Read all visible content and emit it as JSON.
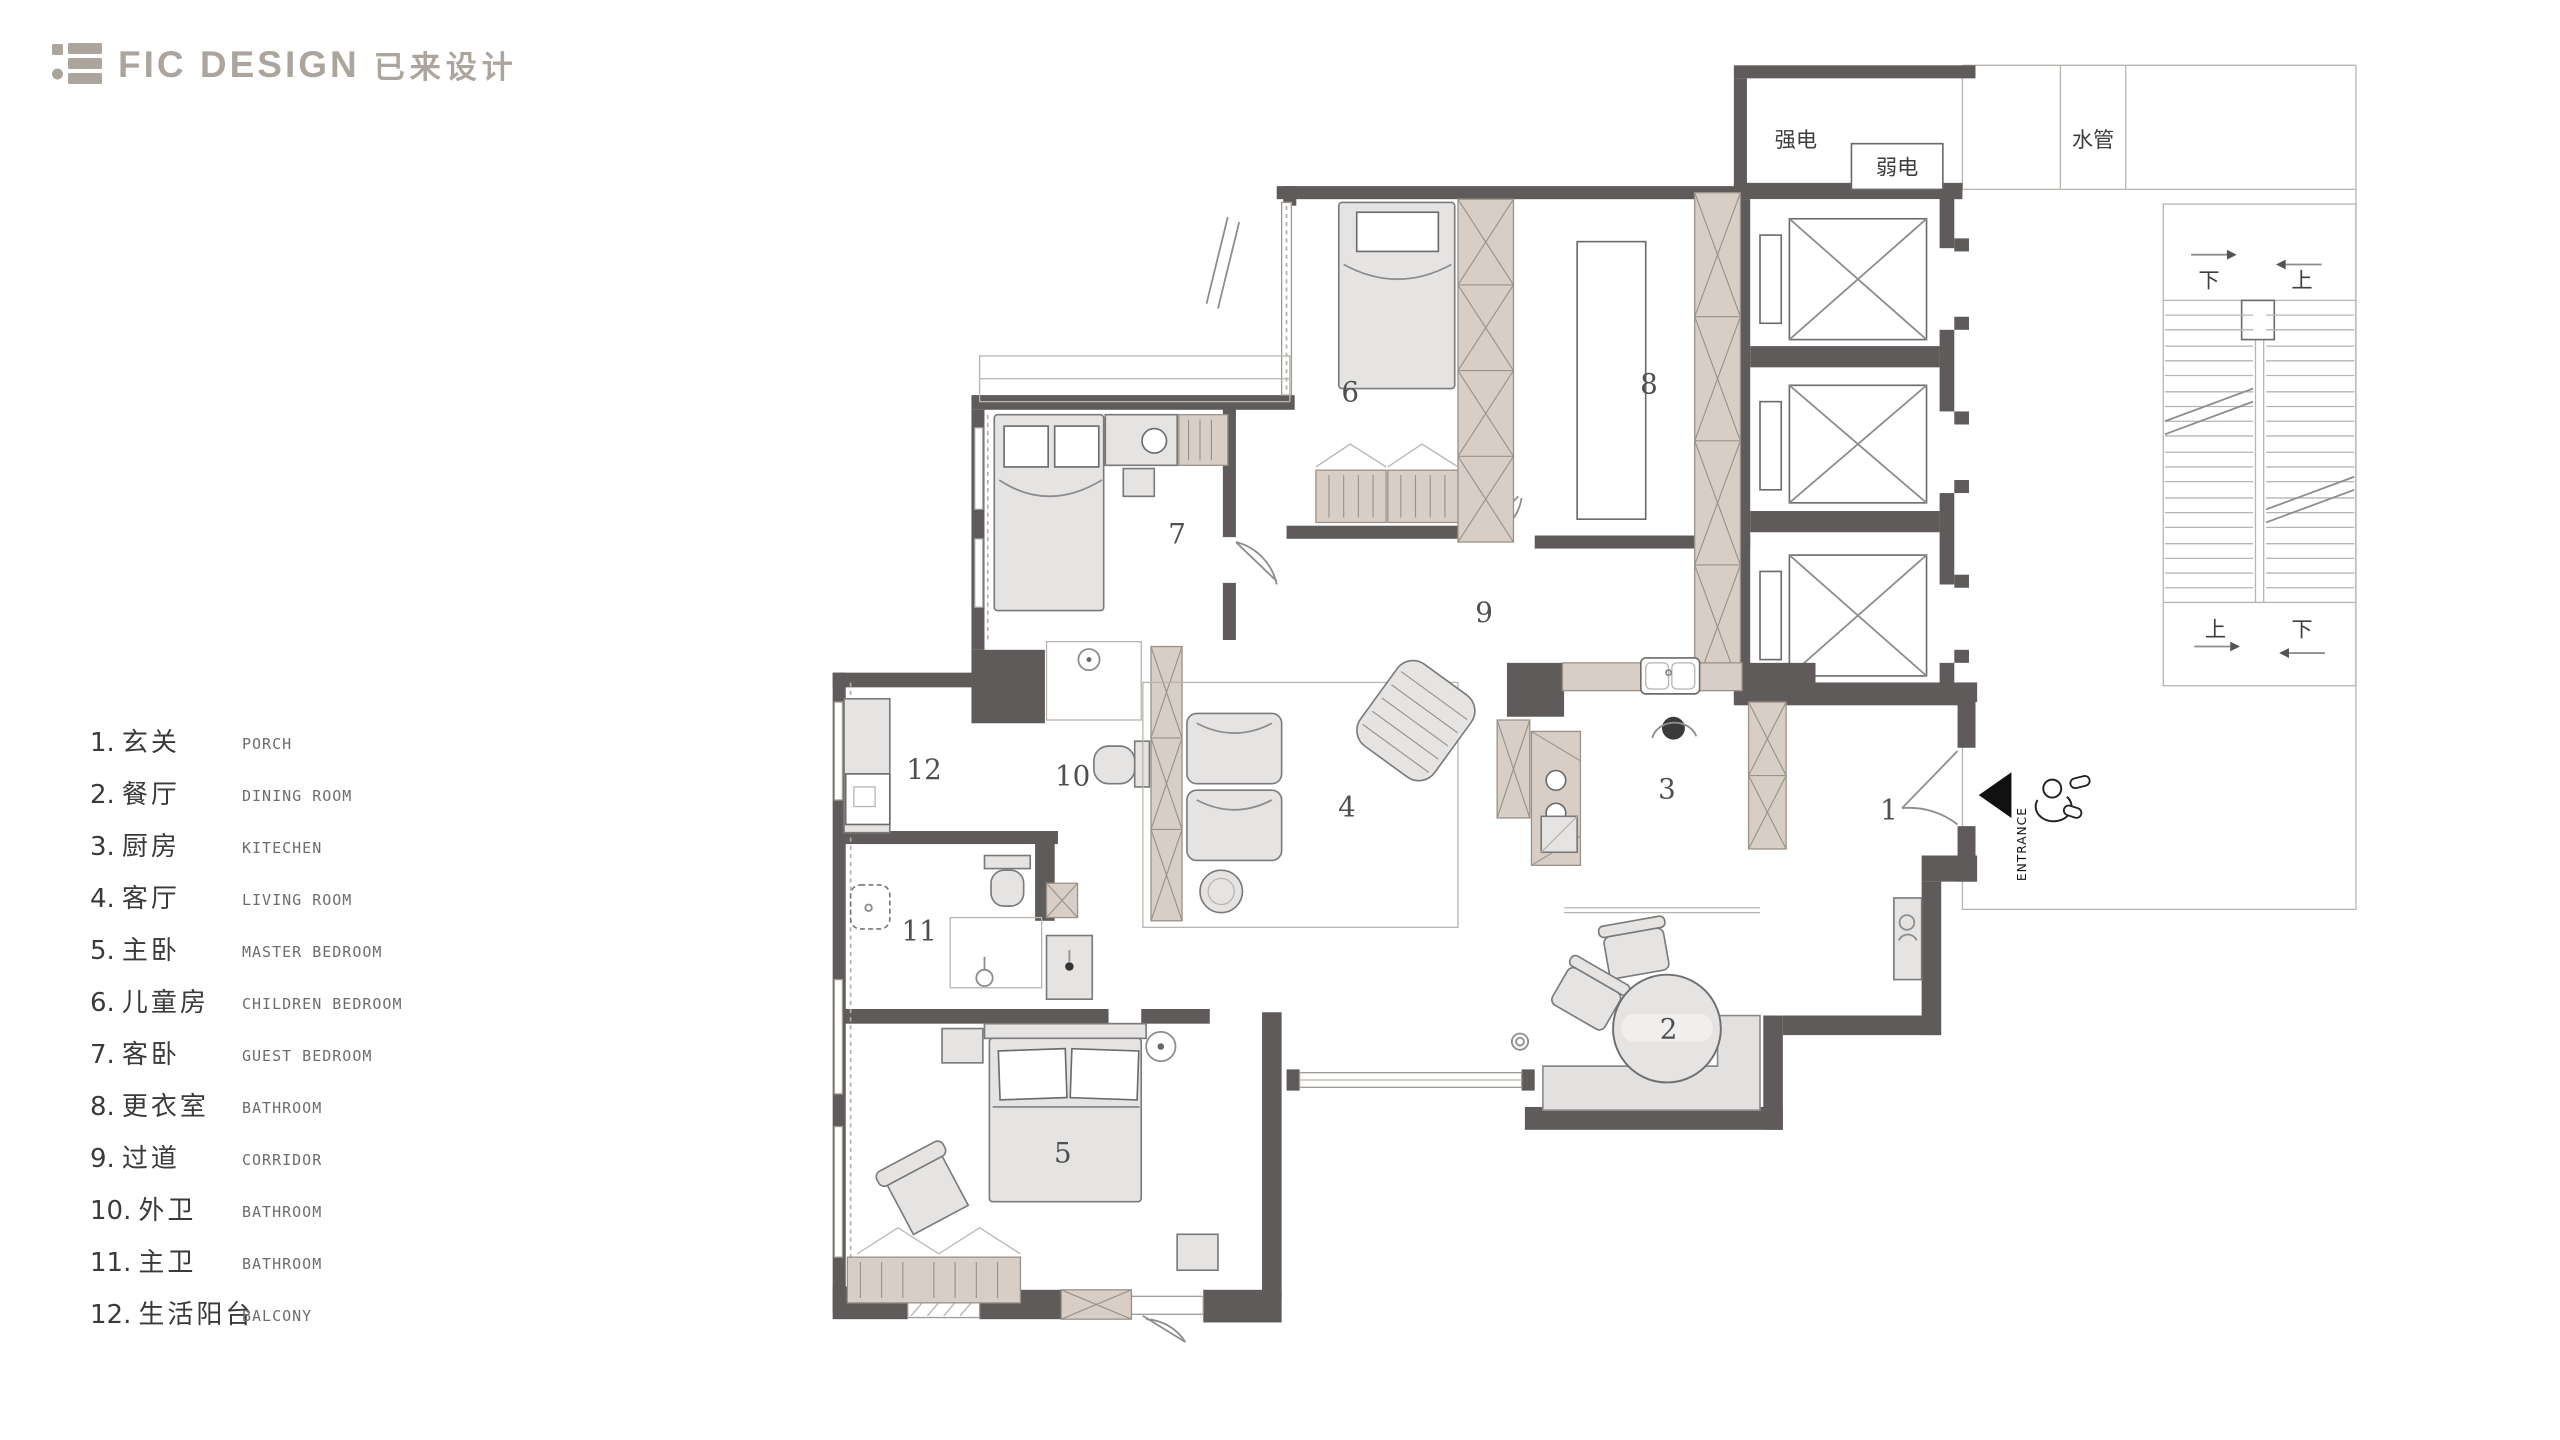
{
  "brand": {
    "name": "FIC DESIGN",
    "suffix": "已来设计"
  },
  "legend": {
    "items": [
      {
        "num": "1.",
        "cn": "玄关",
        "en": "PORCH"
      },
      {
        "num": "2.",
        "cn": "餐厅",
        "en": "DINING ROOM"
      },
      {
        "num": "3.",
        "cn": "厨房",
        "en": "KITECHEN"
      },
      {
        "num": "4.",
        "cn": "客厅",
        "en": "LIVING ROOM"
      },
      {
        "num": "5.",
        "cn": "主卧",
        "en": "MASTER BEDROOM"
      },
      {
        "num": "6.",
        "cn": "儿童房",
        "en": "CHILDREN BEDROOM"
      },
      {
        "num": "7.",
        "cn": "客卧",
        "en": "GUEST BEDROOM"
      },
      {
        "num": "8.",
        "cn": "更衣室",
        "en": "BATHROOM"
      },
      {
        "num": "9.",
        "cn": "过道",
        "en": "CORRIDOR"
      },
      {
        "num": "10.",
        "cn": "外卫",
        "en": "BATHROOM"
      },
      {
        "num": "11.",
        "cn": "主卫",
        "en": "BATHROOM"
      },
      {
        "num": "12.",
        "cn": "生活阳台",
        "en": "BALCONY"
      }
    ]
  },
  "plan": {
    "labels": {
      "strong_power": "强电",
      "weak_power": "弱电",
      "water_pipe": "水管",
      "entrance": "ENTRANCE",
      "stair_top_left": "下",
      "stair_top_right": "上",
      "stair_bottom_left": "上",
      "stair_bottom_right": "下"
    },
    "room_numbers": {
      "r1": "1",
      "r2": "2",
      "r3": "3",
      "r4": "4",
      "r5": "5",
      "r6": "6",
      "r7": "7",
      "r8": "8",
      "r9": "9",
      "r10": "10",
      "r11": "11",
      "r12": "12"
    }
  },
  "colors": {
    "wall": "#5f5b5b",
    "cabinet": "#d8cec6",
    "furniture": "#e6e4e3",
    "logo_gray": "#aba59e",
    "entrance_arrow": "#111111"
  }
}
